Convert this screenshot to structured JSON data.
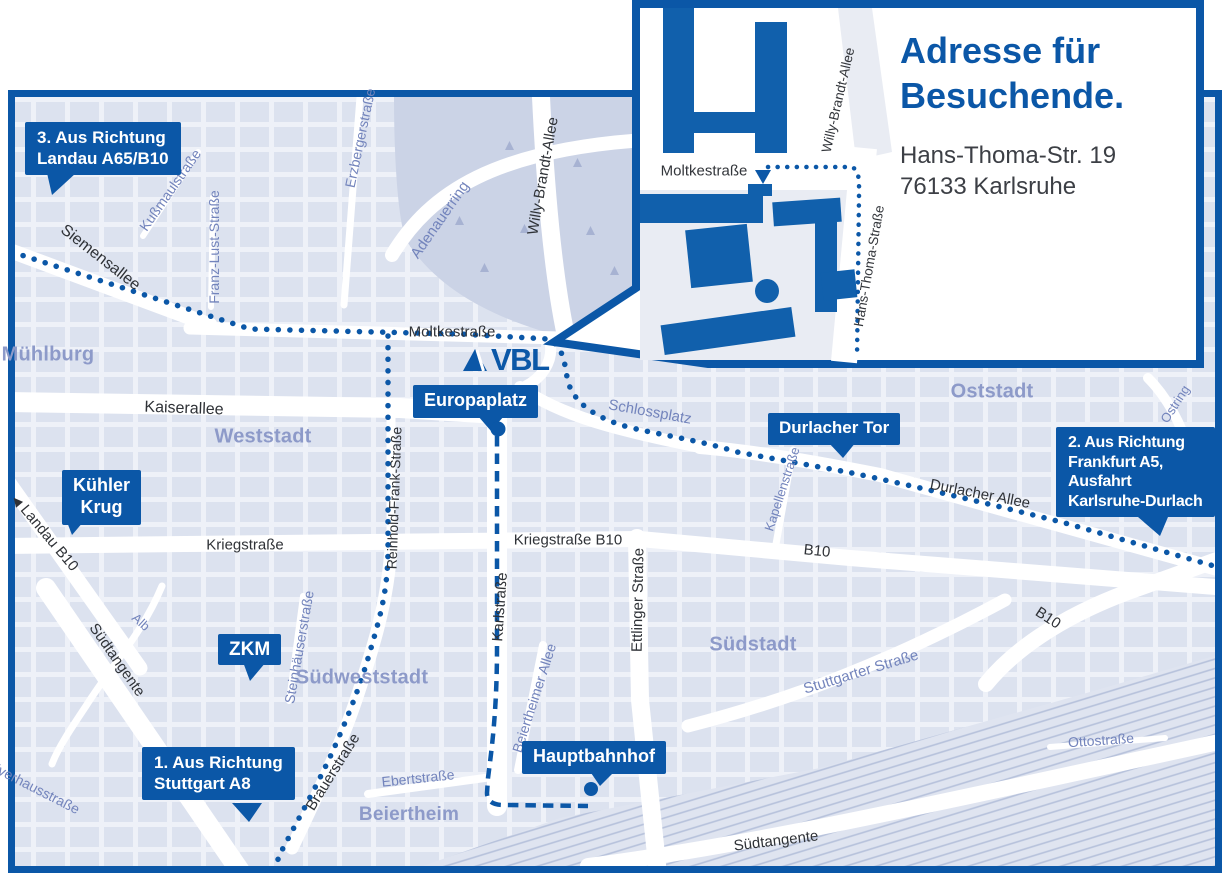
{
  "colors": {
    "accent": "#0B57A7"
  },
  "logo": {
    "text": "VBL"
  },
  "inset": {
    "title_line1": "Adresse für",
    "title_line2": "Besuchende.",
    "address_line1": "Hans-Thoma-Str. 19",
    "address_line2": "76133 Karlsruhe",
    "street_moltkestrasse": "Moltkestraße",
    "street_willy_brandt_allee": "Willy-Brandt-Allee",
    "street_hans_thoma_strasse": "Hans-Thoma-Straße"
  },
  "badges": {
    "route3": {
      "line1": "3. Aus Richtung",
      "line2": "Landau A65/B10"
    },
    "route2": {
      "line1": "2. Aus Richtung",
      "line2": "Frankfurt A5,",
      "line3": "Ausfahrt",
      "line4": "Karlsruhe-Durlach"
    },
    "route1": {
      "line1": "1. Aus Richtung",
      "line2": "Stuttgart A8"
    },
    "europaplatz": "Europaplatz",
    "durlacher_tor": "Durlacher Tor",
    "kuehler_krug": {
      "line1": "Kühler",
      "line2": "Krug"
    },
    "zkm": "ZKM",
    "hauptbahnhof": "Hauptbahnhof"
  },
  "districts": {
    "muehlburg": "Mühlburg",
    "weststadt": "Weststadt",
    "oststadt": "Oststadt",
    "suedstadt": "Südstadt",
    "suedweststadt": "Südweststadt",
    "beiertheim": "Beiertheim"
  },
  "streets": {
    "siemensallee": "Siemensallee",
    "kussmaulstrasse": "Kußmaulstraße",
    "franz_lust_strasse": "Franz-Lust-Straße",
    "erzbergerstrasse": "Erzbergerstraße",
    "adenauerring": "Adenauerring",
    "willy_brandt_allee": "Willy-Brandt-Allee",
    "moltkestrasse": "Moltkestraße",
    "kaiserallee": "Kaiserallee",
    "schlossplatz": "Schlossplatz",
    "durlacher_allee": "Durlacher Allee",
    "kapellenstrasse": "Kapellenstraße",
    "kriegstrasse": "Kriegstraße",
    "kriegstrasse_b10": "Kriegstraße B10",
    "karlstrasse": "Karlstraße",
    "ettlinger_strasse": "Ettlinger Straße",
    "reinhold_frank_strasse": "Reinhold-Frank-Straße",
    "b10_east": "B10",
    "b10_southeast": "B10",
    "landau_b10": "Landau B10",
    "suedtangente_west": "Südtangente",
    "alb": "Alb",
    "steinhaeuserstrasse": "Steinhäuserstraße",
    "brauerstrasse": "Brauerstraße",
    "ebertstrasse": "Ebertstraße",
    "beiertheimer_allee": "Beiertheimer Allee",
    "stuttgarter_strasse": "Stuttgarter Straße",
    "ottostrasse": "Ottostraße",
    "pulverhausstrasse": "Pulverhausstraße",
    "suedtangente_sued": "Südtangente",
    "ostring": "Ostring"
  },
  "icons": {
    "landau_direction_arrow": "◀"
  }
}
